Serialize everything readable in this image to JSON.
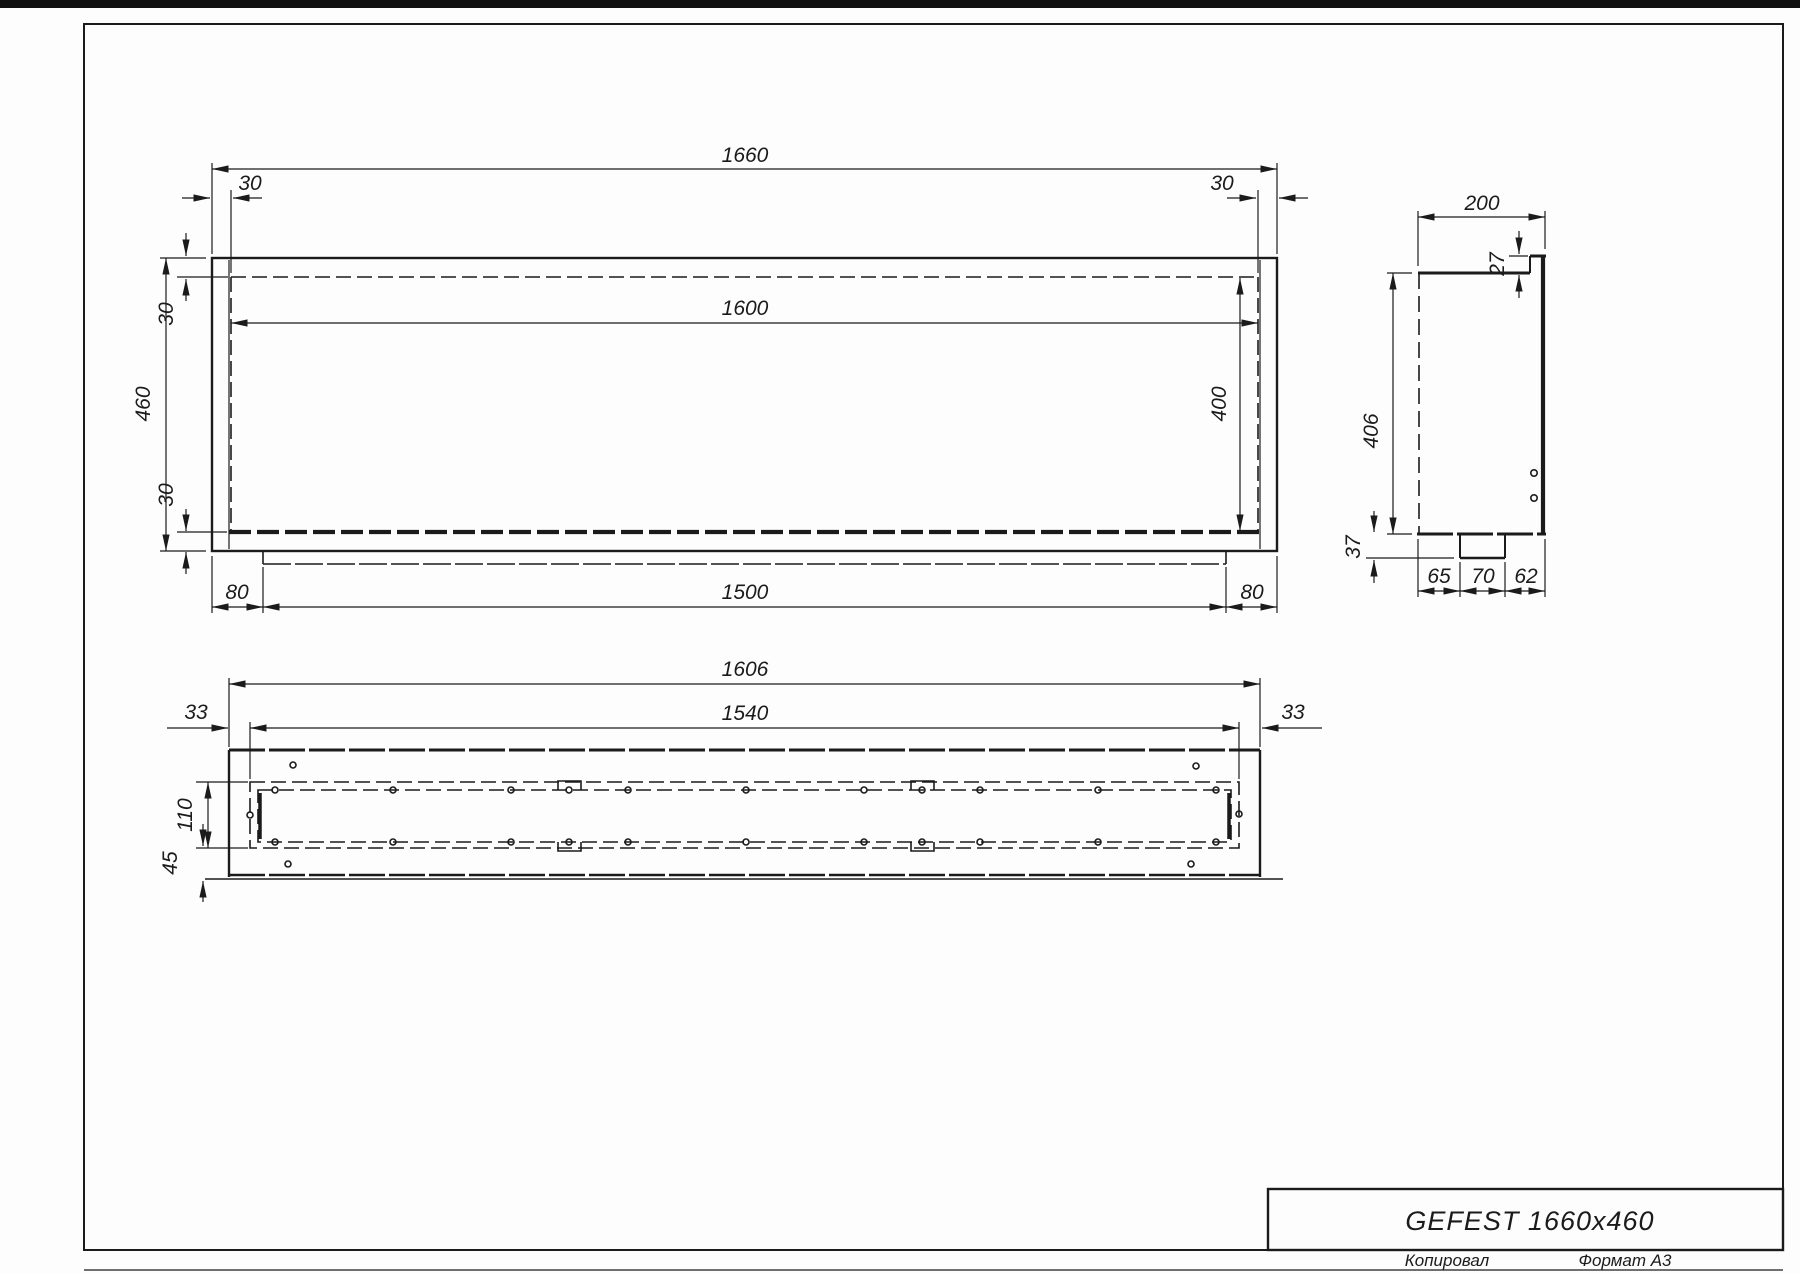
{
  "sheet": {
    "title": "GEFEST 1660x460",
    "footer_copied": "Копировал",
    "footer_format": "Формат А3"
  },
  "front_view": {
    "overall_width": "1660",
    "flange_left": "30",
    "flange_right": "30",
    "opening_width": "1600",
    "opening_height": "400",
    "overall_height": "460",
    "top_inset": "30",
    "bottom_inset": "30",
    "tray_offset_left": "80",
    "tray_width": "1500",
    "tray_offset_right": "80"
  },
  "side_view": {
    "depth": "200",
    "flange_height": "27",
    "body_height": "406",
    "notch_height": "37",
    "notch_offset": "65",
    "notch_width": "70",
    "notch_to_front": "62"
  },
  "plan_view": {
    "body_width": "1606",
    "burner_width": "1540",
    "inset_left": "33",
    "inset_right": "33",
    "burner_depth": "110",
    "front_gap": "45"
  }
}
